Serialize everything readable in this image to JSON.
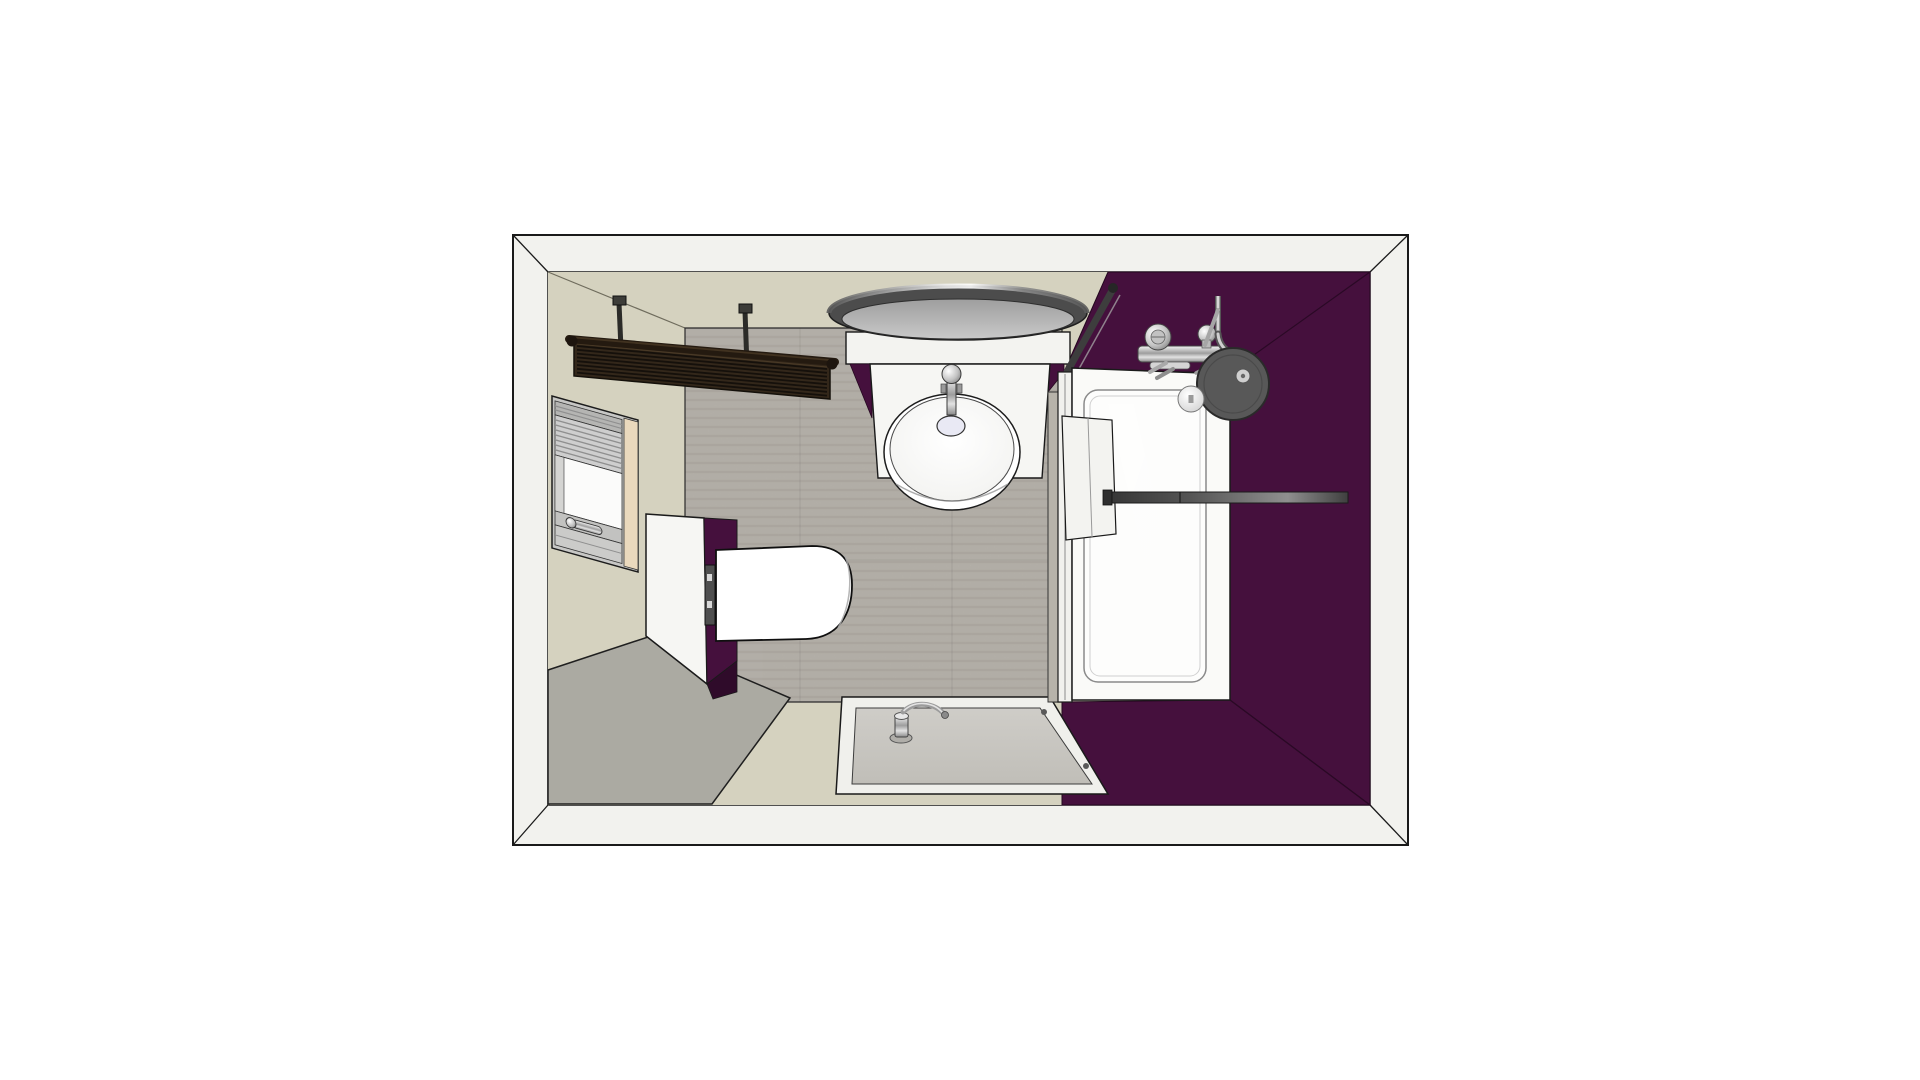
{
  "scene": {
    "type": "3d-interior-render",
    "subject": "bathroom-floor-plan-top-view",
    "view": "top-down perspective",
    "background": "#ffffff"
  },
  "colors": {
    "outline": "#1a1a1a",
    "wall_band": "#f2f2ee",
    "wall_beige": "#d5d2bf",
    "wall_purple": "#45103d",
    "purple_dark": "#2f0b2a",
    "floor_tile": "#b6b2aa",
    "mat": "#abaaa2",
    "fixture_white": "#f6f6f3",
    "panel_white": "#f3f3f0",
    "shower_white": "#fafaf8",
    "shower_inner": "#fdfdfc",
    "tray_rim": "#f0f0ec",
    "tray_gray": "#c8c6c1",
    "radiator_brown": "#33271a",
    "disc_ring": "#4c4c4c",
    "disc_face": "#b9b9b9",
    "basin_white": "#ffffff",
    "curb_tile": "#b7b3aa",
    "glass_edge": "#3d3d3d",
    "towel_bar_dark": "#3a3a3a",
    "cream_reveal": "#ead9bd",
    "window_frame": "#c7c7c5",
    "flush_plate": "#4f4f4f",
    "head_disc": "#585858"
  },
  "objects": {
    "room": "bathroom-room-shell",
    "radiator": "towel-radiator",
    "ceiling_light": "round-ceiling-light",
    "vanity": "washbasin-vanity",
    "basin": "round-washbasin",
    "faucet": "basin-faucet",
    "drain": "basin-drain",
    "window": "window-with-blinds",
    "window_handle": "window-handle",
    "toilet": "wall-hung-toilet",
    "toilet_panel": "toilet-cistern-panel",
    "toilet_partition": "purple-partition-wall",
    "flush_panel": "toilet-flush-plate",
    "shower": "walk-in-shower-enclosure",
    "shower_door": "shower-door-panel",
    "glass_screen": "glass-screen-edge",
    "mixer": "shower-mixer-valve",
    "shower_head": "rain-shower-head",
    "shower_handle": "shower-ball-handle",
    "towel_bar": "wall-towel-bar",
    "tray": "shower-tray",
    "tray_drain": "tray-drain-fitting",
    "mat": "bath-mat"
  }
}
